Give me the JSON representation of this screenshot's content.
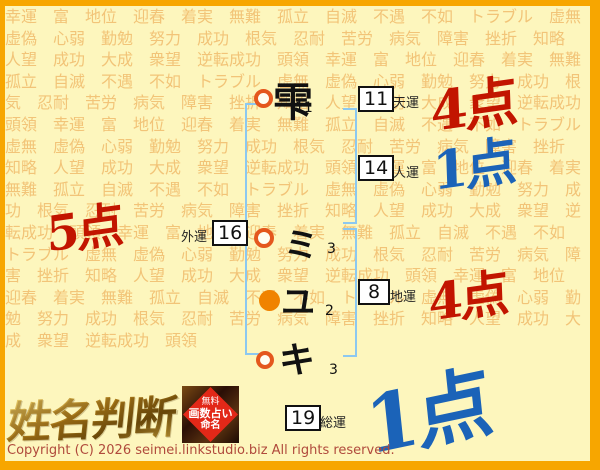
{
  "background": {
    "words": [
      "幸運",
      "富",
      "地位",
      "迎春",
      "着実",
      "無難",
      "孤立",
      "自滅",
      "不遇",
      "不如",
      "トラブル",
      "虚無",
      "虚偽",
      "心弱",
      "勤勉",
      "努力",
      "成功",
      "根気",
      "忍耐",
      "苦労",
      "病気",
      "障害",
      "挫折",
      "知略",
      "人望",
      "成功",
      "大成",
      "衆望",
      "逆転成功",
      "頭領"
    ],
    "repeat": 6
  },
  "diagram": {
    "name_chars": [
      {
        "char": "雫",
        "strokes": "11",
        "marker": "outline"
      },
      {
        "char": "ミ",
        "strokes": "3",
        "marker": "outline"
      },
      {
        "char": "ユ",
        "strokes": "2",
        "marker": "filled"
      },
      {
        "char": "キ",
        "strokes": "3",
        "marker": "outline"
      }
    ],
    "fortunes": {
      "tenun": {
        "label": "天運",
        "value": "11",
        "score": "4点",
        "score_color": "#c21500"
      },
      "jinun": {
        "label": "人運",
        "value": "14",
        "score": "1点",
        "score_color": "#1b63b8"
      },
      "gaiun": {
        "label": "外運",
        "value": "16",
        "score": "5点",
        "score_color": "#c21500"
      },
      "chiun": {
        "label": "地運",
        "value": "8",
        "score": "4点",
        "score_color": "#c21500"
      },
      "soun": {
        "label": "総運",
        "value": "19",
        "score": "1点",
        "score_color": "#1b63b8"
      }
    }
  },
  "footer": {
    "logo": "姓名判断",
    "stamp_lines": [
      "無料",
      "画数占い",
      "命名"
    ],
    "copyright": "Copyright (C) 2026 seimei.linkstudio.biz All rights reserved."
  },
  "colors": {
    "frame_orange": "#f7a600",
    "bracket_blue": "#8cc8f0",
    "pattern_text": "#f2c478",
    "page_background": "#fdf6bd"
  }
}
